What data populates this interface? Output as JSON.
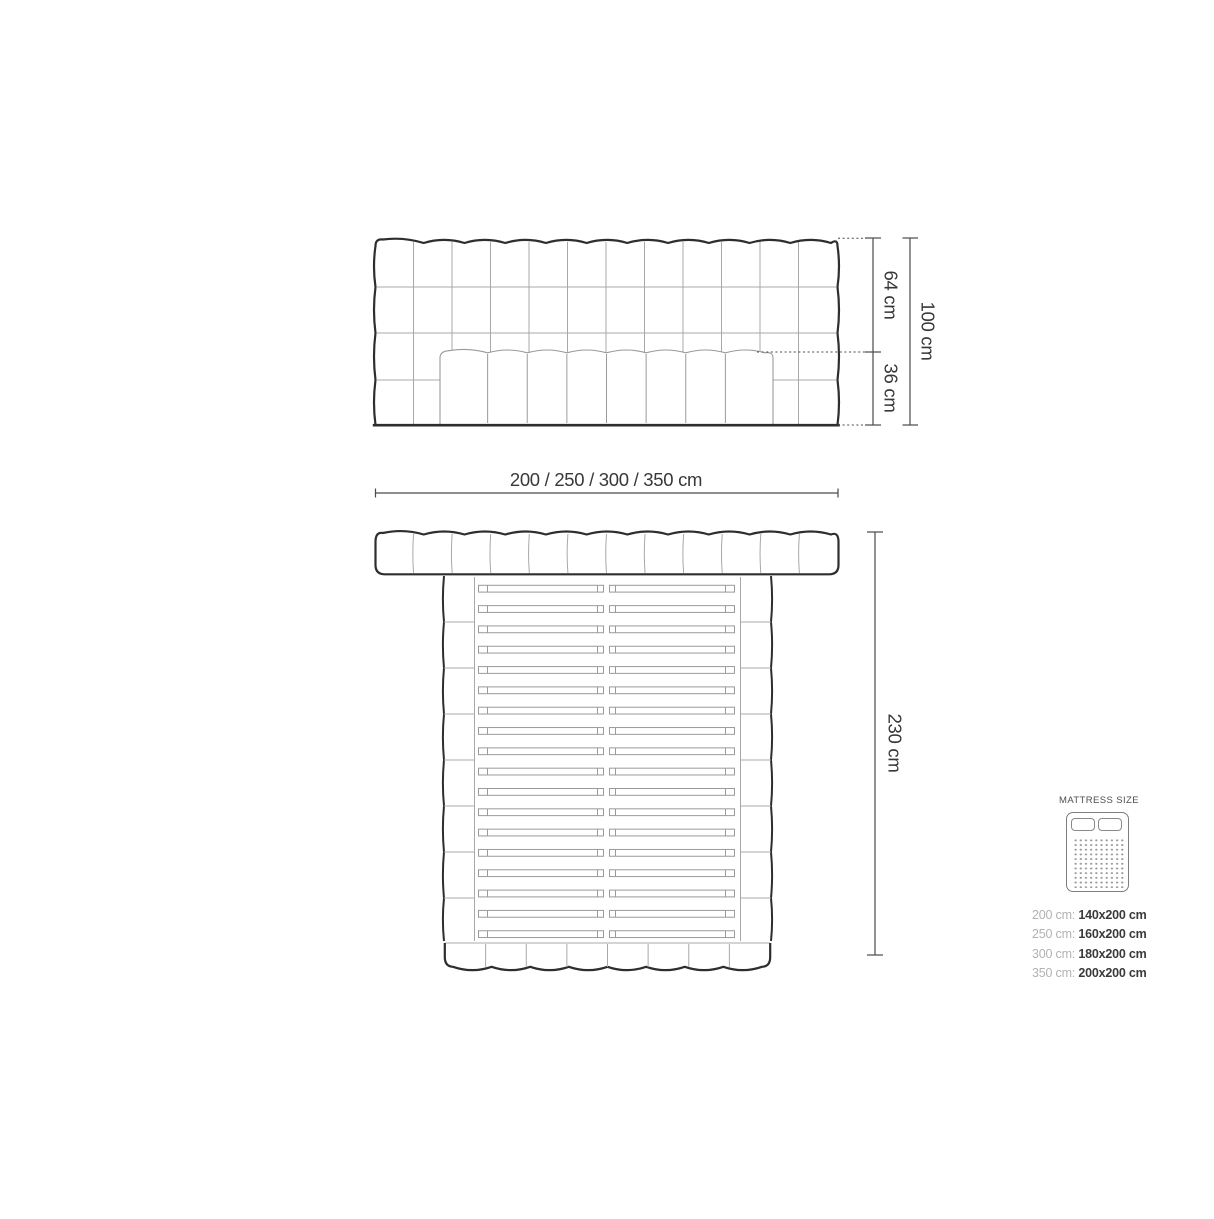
{
  "front_view": {
    "height_upper_label": "64 cm",
    "height_lower_label": "36 cm",
    "height_total_label": "100 cm"
  },
  "width_label": "200 / 250 / 300 / 350 cm",
  "top_view": {
    "depth_label": "230 cm"
  },
  "legend": {
    "title": "MATTRESS SIZE",
    "rows": [
      {
        "size": "200 cm:",
        "mattress": "140x200 cm"
      },
      {
        "size": "250 cm:",
        "mattress": "160x200 cm"
      },
      {
        "size": "300 cm:",
        "mattress": "180x200 cm"
      },
      {
        "size": "350 cm:",
        "mattress": "200x200 cm"
      }
    ]
  },
  "colors": {
    "outline": "#2e2e2e",
    "grid": "#a8a8a8",
    "detail": "#9a9a9a",
    "dimension": "#4a4a4a",
    "text": "#383838",
    "legend_gray": "#b2b2b2"
  }
}
